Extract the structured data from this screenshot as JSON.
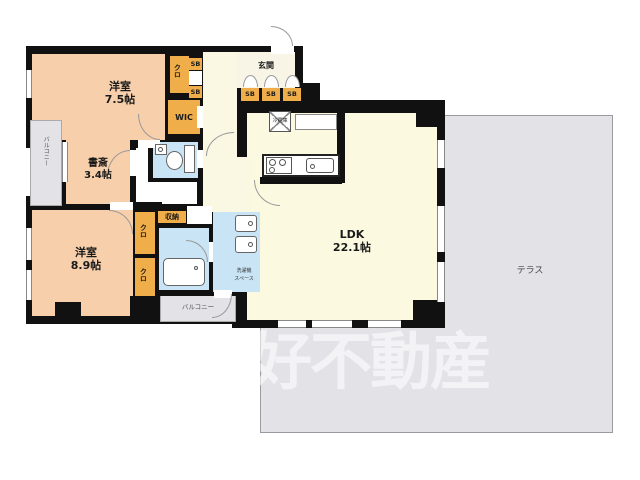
{
  "watermark": "好不動産",
  "rooms": {
    "western_room_1": {
      "name": "洋室",
      "size": "7.5帖"
    },
    "study": {
      "name": "書斎",
      "size": "3.4帖"
    },
    "western_room_2": {
      "name": "洋室",
      "size": "8.9帖"
    },
    "ldk": {
      "name": "LDK",
      "size": "22.1帖"
    },
    "entrance": {
      "label": "玄関"
    },
    "terrace": {
      "label": "テラス"
    },
    "balcony_left": {
      "label": "バルコニー"
    },
    "balcony_bottom": {
      "label": "バルコニー"
    },
    "wic": {
      "label": "WIC"
    },
    "closet": {
      "label": "クロ"
    },
    "shoe_box": {
      "label": "SB"
    },
    "storage": {
      "label": "収納"
    },
    "refrigerator": {
      "label": "冷蔵庫"
    },
    "laundry_space": {
      "line1": "洗濯機",
      "line2": "スペース"
    }
  },
  "colors": {
    "room_peach": "#f8cfab",
    "storage_orange": "#f0ae4b",
    "living_cream": "#fbfae1",
    "wet_area_blue": "#c9e5f5",
    "outdoor_gray": "#e3e2e6",
    "wall_black": "#111111"
  }
}
